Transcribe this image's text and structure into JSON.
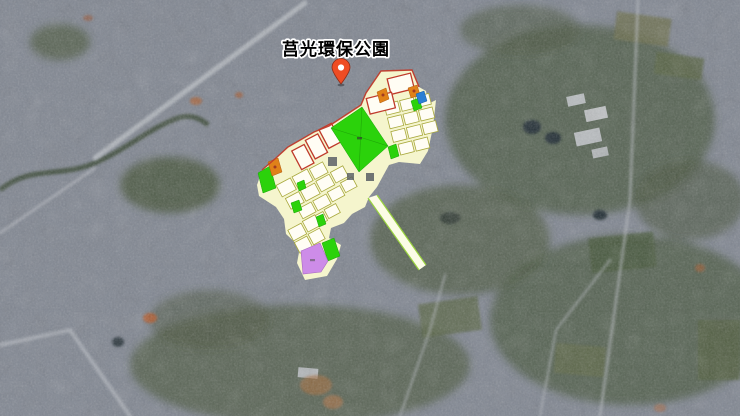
{
  "map": {
    "place_label": "莒光環保公園",
    "marker": {
      "icon": "location-pin"
    },
    "overlay": {
      "type": "urban-zoning-plan",
      "features": [
        "park-parcel-green",
        "residential-parcels-white",
        "red-bordered-parcels",
        "orange-parcels",
        "blue-parcel",
        "purple-parcel",
        "planned-road-strip"
      ]
    }
  },
  "palette": {
    "base_land": "#828893",
    "road_light": "#b9bdc3",
    "veg_dark": "#4b5840",
    "water_dark": "#232f36",
    "plan_cream": "#f5f5cd",
    "plan_parcel_white": "#fffdf4",
    "plan_parcel_border": "#a8a83c",
    "plan_red": "#bf3a2b",
    "plan_green": "#2bd20b",
    "plan_orange": "#e08119",
    "plan_blue": "#2b7fd4",
    "plan_purple": "#cd8ce8",
    "marker_red": "#ef4c23",
    "label_text": "#000000",
    "label_halo": "#ffffff"
  }
}
